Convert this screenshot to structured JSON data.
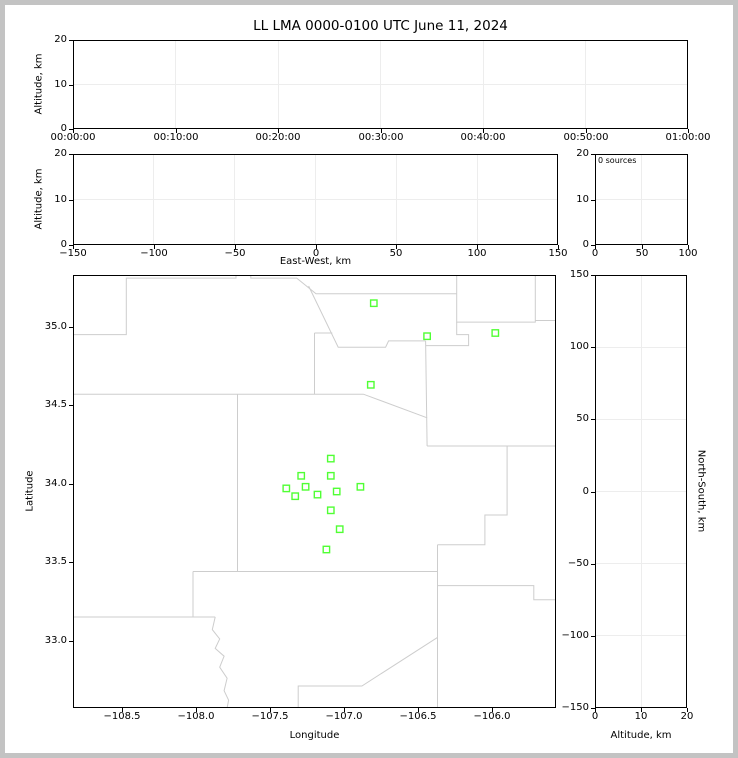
{
  "window": {
    "title": "LL LMA 0000-0100 UTC June 11, 2024"
  },
  "colors": {
    "station_green": "#50ff34",
    "county_line": "#cdcdcd",
    "frame": "#000000",
    "grid": "#ededed",
    "page_border": "#c3c3c3",
    "background": "#ffffff"
  },
  "chart_data": [
    {
      "id": "time_height",
      "type": "scatter",
      "title": "LL LMA 0000-0100 UTC June 11, 2024",
      "xlabel": "",
      "ylabel": "Altitude, km",
      "xlim": [
        0,
        60
      ],
      "ylim": [
        0,
        20
      ],
      "x_tick_values": [
        0,
        10,
        20,
        30,
        40,
        50,
        60
      ],
      "x_tick_labels": [
        "00:00:00",
        "00:10:00",
        "00:20:00",
        "00:30:00",
        "00:40:00",
        "00:50:00",
        "01:00:00"
      ],
      "y_tick_values": [
        0,
        10,
        20
      ],
      "y_tick_labels": [
        "0",
        "10",
        "20"
      ],
      "grid": true,
      "points": []
    },
    {
      "id": "ew_height",
      "type": "scatter",
      "xlabel": "East-West, km",
      "ylabel": "Altitude, km",
      "xlim": [
        -150,
        150
      ],
      "ylim": [
        0,
        20
      ],
      "x_tick_values": [
        -150,
        -100,
        -50,
        0,
        50,
        100,
        150
      ],
      "x_tick_labels": [
        "−150",
        "−100",
        "−50",
        "0",
        "50",
        "100",
        "150"
      ],
      "y_tick_values": [
        0,
        10,
        20
      ],
      "y_tick_labels": [
        "0",
        "10",
        "20"
      ],
      "grid": true,
      "points": []
    },
    {
      "id": "height_histogram",
      "type": "line",
      "xlabel": "",
      "ylabel": "",
      "annotation": "0 sources",
      "xlim": [
        0,
        100
      ],
      "ylim": [
        0,
        20
      ],
      "x_tick_values": [
        0,
        50,
        100
      ],
      "x_tick_labels": [
        "0",
        "50",
        "100"
      ],
      "y_tick_values": [
        0,
        10,
        20
      ],
      "y_tick_labels": [
        "0",
        "10",
        "20"
      ],
      "grid": true,
      "points": []
    },
    {
      "id": "plan_map",
      "type": "scatter",
      "xlabel": "Longitude",
      "ylabel": "Latitude",
      "xlim": [
        -108.83,
        -105.57
      ],
      "ylim": [
        32.57,
        35.33
      ],
      "x_tick_values": [
        -108.5,
        -108.0,
        -107.5,
        -107.0,
        -106.5,
        -106.0
      ],
      "x_tick_labels": [
        "−108.5",
        "−108.0",
        "−107.5",
        "−107.0",
        "−106.5",
        "−106.0"
      ],
      "y_tick_values": [
        33.0,
        33.5,
        34.0,
        34.5,
        35.0
      ],
      "y_tick_labels": [
        "33.0",
        "33.5",
        "34.0",
        "34.5",
        "35.0"
      ],
      "grid": false,
      "stations": [
        [
          -106.8,
          35.15
        ],
        [
          -106.44,
          34.94
        ],
        [
          -105.98,
          34.96
        ],
        [
          -106.82,
          34.63
        ],
        [
          -107.09,
          34.16
        ],
        [
          -107.29,
          34.05
        ],
        [
          -107.09,
          34.05
        ],
        [
          -107.39,
          33.97
        ],
        [
          -107.26,
          33.98
        ],
        [
          -107.33,
          33.92
        ],
        [
          -107.18,
          33.93
        ],
        [
          -107.05,
          33.95
        ],
        [
          -106.89,
          33.98
        ],
        [
          -107.09,
          33.83
        ],
        [
          -107.03,
          33.71
        ],
        [
          -107.12,
          33.58
        ]
      ],
      "county_lines": [
        [
          [
            -108.83,
            34.95
          ],
          [
            -108.47,
            34.95
          ],
          [
            -108.47,
            35.31
          ],
          [
            -107.73,
            35.31
          ],
          [
            -107.73,
            35.33
          ]
        ],
        [
          [
            -107.63,
            35.33
          ],
          [
            -107.63,
            35.31
          ],
          [
            -107.32,
            35.31
          ],
          [
            -107.19,
            35.21
          ],
          [
            -106.24,
            35.21
          ]
        ],
        [
          [
            -107.24,
            35.26
          ],
          [
            -107.04,
            34.87
          ],
          [
            -106.72,
            34.87
          ],
          [
            -106.7,
            34.91
          ],
          [
            -106.45,
            34.91
          ]
        ],
        [
          [
            -106.24,
            35.33
          ],
          [
            -106.24,
            35.03
          ],
          [
            -105.71,
            35.03
          ],
          [
            -105.71,
            35.33
          ]
        ],
        [
          [
            -105.71,
            35.04
          ],
          [
            -105.57,
            35.04
          ]
        ],
        [
          [
            -106.24,
            35.03
          ],
          [
            -106.24,
            34.95
          ],
          [
            -106.16,
            34.95
          ],
          [
            -106.16,
            34.88
          ],
          [
            -106.45,
            34.88
          ]
        ],
        [
          [
            -106.45,
            34.91
          ],
          [
            -106.44,
            34.24
          ]
        ],
        [
          [
            -108.83,
            34.57
          ],
          [
            -106.87,
            34.57
          ],
          [
            -106.44,
            34.42
          ]
        ],
        [
          [
            -106.44,
            34.24
          ],
          [
            -105.57,
            34.24
          ]
        ],
        [
          [
            -107.72,
            34.57
          ],
          [
            -107.72,
            33.44
          ]
        ],
        [
          [
            -107.2,
            34.96
          ],
          [
            -107.08,
            34.96
          ]
        ],
        [
          [
            -107.2,
            34.96
          ],
          [
            -107.2,
            34.57
          ]
        ],
        [
          [
            -108.02,
            33.44
          ],
          [
            -106.37,
            33.44
          ]
        ],
        [
          [
            -108.02,
            33.44
          ],
          [
            -108.02,
            33.15
          ]
        ],
        [
          [
            -108.83,
            33.15
          ],
          [
            -107.87,
            33.15
          ]
        ],
        [
          [
            -107.87,
            33.15
          ],
          [
            -107.89,
            33.07
          ],
          [
            -107.84,
            33.01
          ],
          [
            -107.87,
            32.95
          ],
          [
            -107.81,
            32.9
          ],
          [
            -107.84,
            32.83
          ],
          [
            -107.79,
            32.76
          ],
          [
            -107.81,
            32.68
          ],
          [
            -107.78,
            32.62
          ],
          [
            -107.79,
            32.57
          ]
        ],
        [
          [
            -105.9,
            34.24
          ],
          [
            -105.9,
            33.8
          ],
          [
            -106.05,
            33.8
          ],
          [
            -106.05,
            33.61
          ],
          [
            -106.37,
            33.61
          ]
        ],
        [
          [
            -106.37,
            33.61
          ],
          [
            -106.37,
            32.57
          ]
        ],
        [
          [
            -106.37,
            33.35
          ],
          [
            -105.72,
            33.35
          ],
          [
            -105.72,
            33.26
          ],
          [
            -105.57,
            33.26
          ]
        ],
        [
          [
            -106.37,
            33.02
          ],
          [
            -106.88,
            32.71
          ],
          [
            -107.31,
            32.71
          ],
          [
            -107.31,
            32.57
          ]
        ]
      ]
    },
    {
      "id": "ns_height",
      "type": "scatter",
      "xlabel": "Altitude, km",
      "ylabel": "North-South, km",
      "xlim": [
        0,
        20
      ],
      "ylim": [
        -150,
        150
      ],
      "x_tick_values": [
        0,
        10,
        20
      ],
      "x_tick_labels": [
        "0",
        "10",
        "20"
      ],
      "y_tick_values": [
        150,
        100,
        50,
        0,
        -50,
        -100,
        -150
      ],
      "y_tick_labels": [
        "150",
        "100",
        "50",
        "0",
        "−50",
        "−100",
        "−150"
      ],
      "grid": true,
      "points": []
    }
  ]
}
